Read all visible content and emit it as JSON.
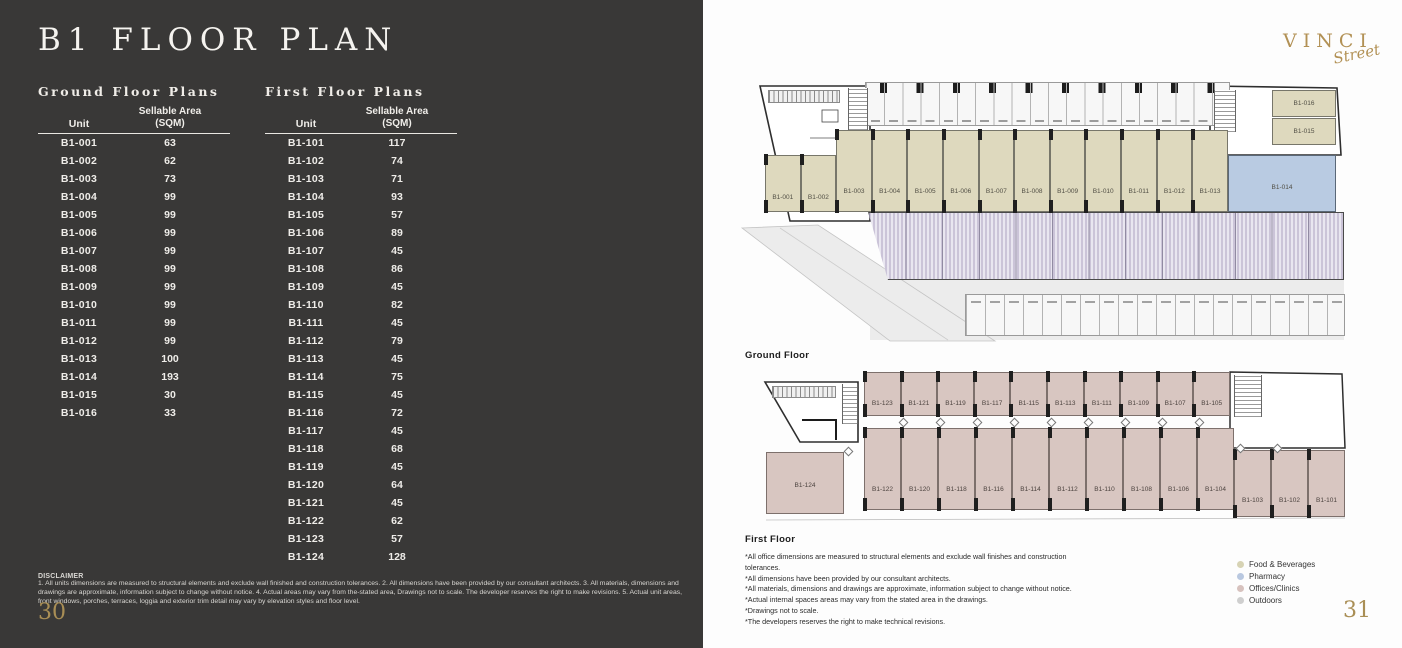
{
  "left_page": {
    "title": "B1 FLOOR PLAN",
    "ground_table": {
      "heading": "Ground Floor Plans",
      "col_unit": "Unit",
      "col_area_l1": "Sellable Area",
      "col_area_l2": "(SQM)",
      "rows": [
        [
          "B1-001",
          "63"
        ],
        [
          "B1-002",
          "62"
        ],
        [
          "B1-003",
          "73"
        ],
        [
          "B1-004",
          "99"
        ],
        [
          "B1-005",
          "99"
        ],
        [
          "B1-006",
          "99"
        ],
        [
          "B1-007",
          "99"
        ],
        [
          "B1-008",
          "99"
        ],
        [
          "B1-009",
          "99"
        ],
        [
          "B1-010",
          "99"
        ],
        [
          "B1-011",
          "99"
        ],
        [
          "B1-012",
          "99"
        ],
        [
          "B1-013",
          "100"
        ],
        [
          "B1-014",
          "193"
        ],
        [
          "B1-015",
          "30"
        ],
        [
          "B1-016",
          "33"
        ]
      ]
    },
    "first_table": {
      "heading": "First Floor Plans",
      "col_unit": "Unit",
      "col_area_l1": "Sellable Area",
      "col_area_l2": "(SQM)",
      "rows": [
        [
          "B1-101",
          "117"
        ],
        [
          "B1-102",
          "74"
        ],
        [
          "B1-103",
          "71"
        ],
        [
          "B1-104",
          "93"
        ],
        [
          "B1-105",
          "57"
        ],
        [
          "B1-106",
          "89"
        ],
        [
          "B1-107",
          "45"
        ],
        [
          "B1-108",
          "86"
        ],
        [
          "B1-109",
          "45"
        ],
        [
          "B1-110",
          "82"
        ],
        [
          "B1-111",
          "45"
        ],
        [
          "B1-112",
          "79"
        ],
        [
          "B1-113",
          "45"
        ],
        [
          "B1-114",
          "75"
        ],
        [
          "B1-115",
          "45"
        ],
        [
          "B1-116",
          "72"
        ],
        [
          "B1-117",
          "45"
        ],
        [
          "B1-118",
          "68"
        ],
        [
          "B1-119",
          "45"
        ],
        [
          "B1-120",
          "64"
        ],
        [
          "B1-121",
          "45"
        ],
        [
          "B1-122",
          "62"
        ],
        [
          "B1-123",
          "57"
        ],
        [
          "B1-124",
          "128"
        ]
      ]
    },
    "disclaimer_title": "DISCLAIMER",
    "disclaimer_text": "1. All units dimensions are measured to structural elements and exclude wall finished and construction tolerances. 2. All dimensions have been provided by our consultant architects. 3. All materials, dimensions and drawings are approximate, information subject to change without notice. 4. Actual areas may vary from the-stated area, Drawings not to scale. The developer reserves the right to make revisions. 5. Actual unit areas, front windows, porches, terraces, loggia and exterior trim detail may vary by elevation styles and floor level.",
    "page_number": "30"
  },
  "right_page": {
    "logo": {
      "word": "VINCI",
      "script": "Street"
    },
    "ground_plan": {
      "label": "Ground Floor",
      "units_main": [
        "B1-001",
        "B1-002",
        "B1-003",
        "B1-004",
        "B1-005",
        "B1-006",
        "B1-007",
        "B1-008",
        "B1-009",
        "B1-010",
        "B1-011",
        "B1-012",
        "B1-013"
      ],
      "unit_pharmacy": "B1-014",
      "units_upper": [
        "B1-016",
        "B1-015"
      ]
    },
    "first_plan": {
      "label": "First Floor",
      "top_row": [
        "B1-123",
        "B1-121",
        "B1-119",
        "B1-117",
        "B1-115",
        "B1-113",
        "B1-111",
        "B1-109",
        "B1-107",
        "B1-105"
      ],
      "bottom_row": [
        "B1-122",
        "B1-120",
        "B1-118",
        "B1-116",
        "B1-114",
        "B1-112",
        "B1-110",
        "B1-108",
        "B1-106",
        "B1-104",
        "B1-103",
        "B1-102",
        "B1-101"
      ],
      "corner_unit": "B1-124"
    },
    "notes": [
      "*All office dimensions are measured to structural elements and exclude wall finishes and construction tolerances.",
      "*All dimensions have been provided by our consultant architects.",
      "*All materials, dimensions and drawings are approximate, information subject to change without notice.",
      "*Actual internal spaces areas may vary from the stated area in the drawings.",
      "*Drawings not to scale.",
      "*The developers reserves the right to make technical revisions."
    ],
    "legend": [
      {
        "label": "Food & Beverages",
        "color": "#d7d3b4"
      },
      {
        "label": "Pharmacy",
        "color": "#b9c8e0"
      },
      {
        "label": "Offices/Clinics",
        "color": "#d7c2be"
      },
      {
        "label": "Outdoors",
        "color": "#cfcfcf"
      }
    ],
    "colors": {
      "fnb": "#ded9be",
      "pharmacy": "#b9cbe2",
      "office": "#d8c6c1",
      "outdoor": "#ececec",
      "gold": "#b29155"
    },
    "page_number": "31"
  }
}
